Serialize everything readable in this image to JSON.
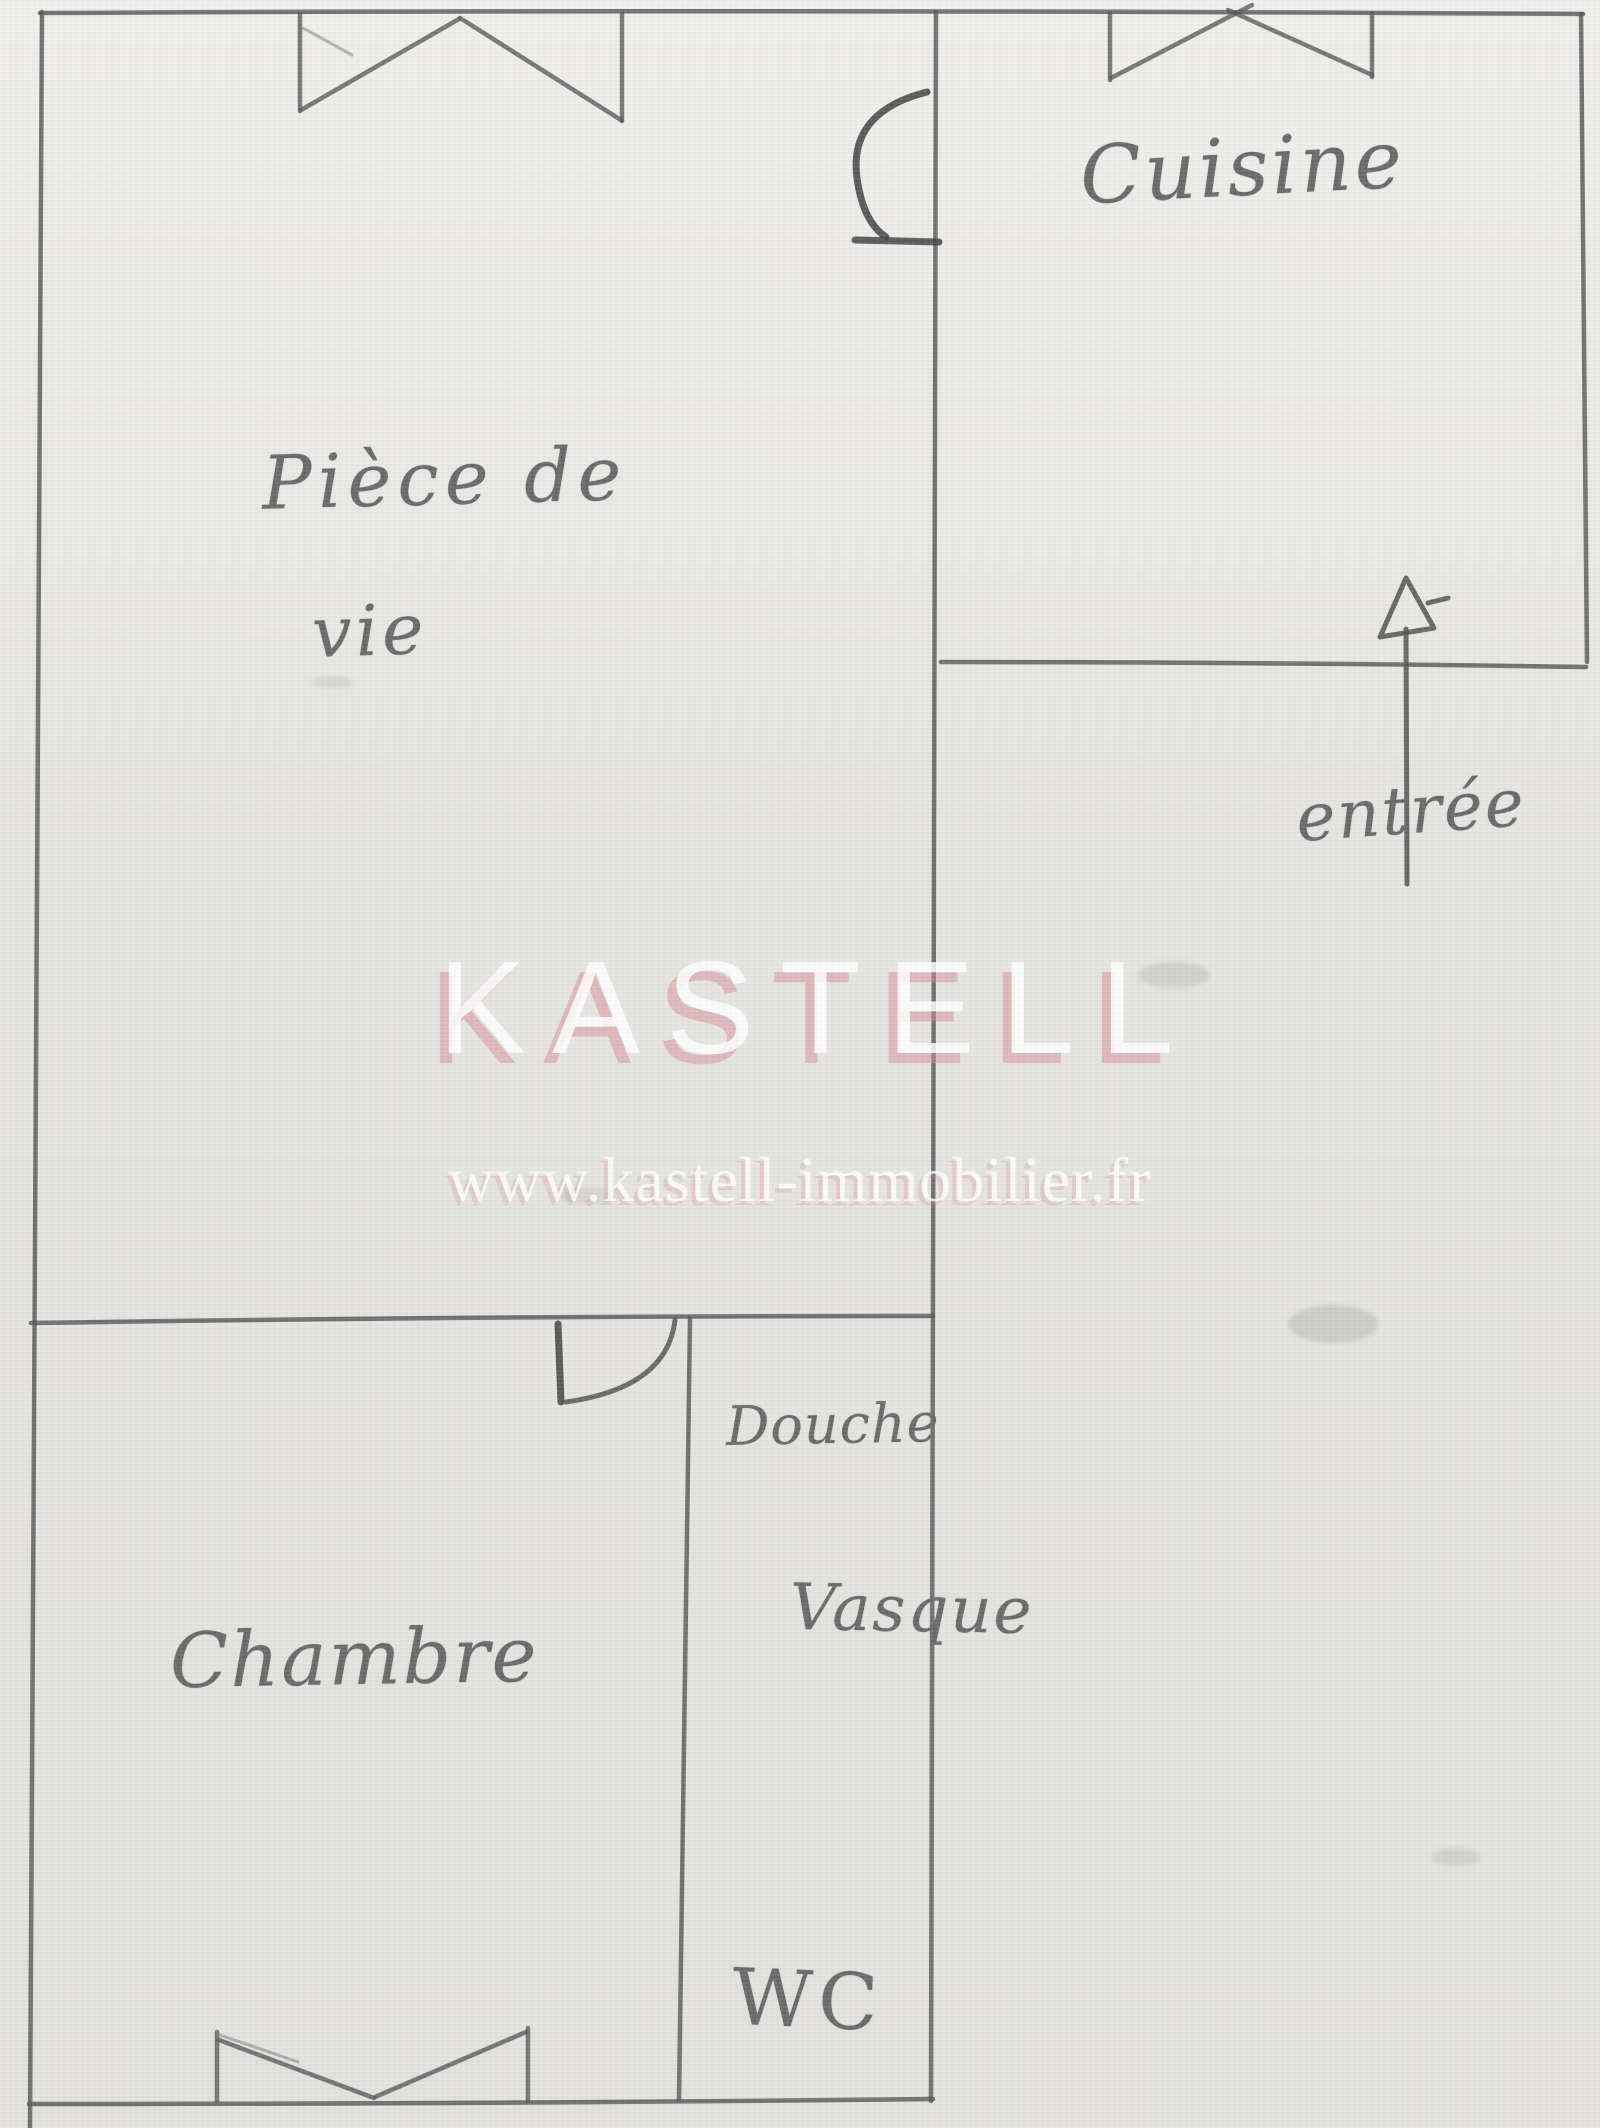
{
  "rooms": {
    "living": {
      "line1": "Pièce de",
      "line2": "vie"
    },
    "kitchen": {
      "label": "Cuisine"
    },
    "bedroom": {
      "label": "Chambre"
    },
    "shower": {
      "label": "Douche"
    },
    "basin": {
      "label": "Vasque"
    },
    "toilet": {
      "label": "WC"
    }
  },
  "entrance": {
    "label": "entrée"
  },
  "watermark": {
    "brand": "KASTELL",
    "url": "www.kastell-immobilier.fr"
  },
  "palette": {
    "paper": "#e9e8e5",
    "pencil_wall": "#565656",
    "pencil_text": "#686868",
    "watermark_white": "#ffffff",
    "watermark_pink": "#d68996"
  }
}
